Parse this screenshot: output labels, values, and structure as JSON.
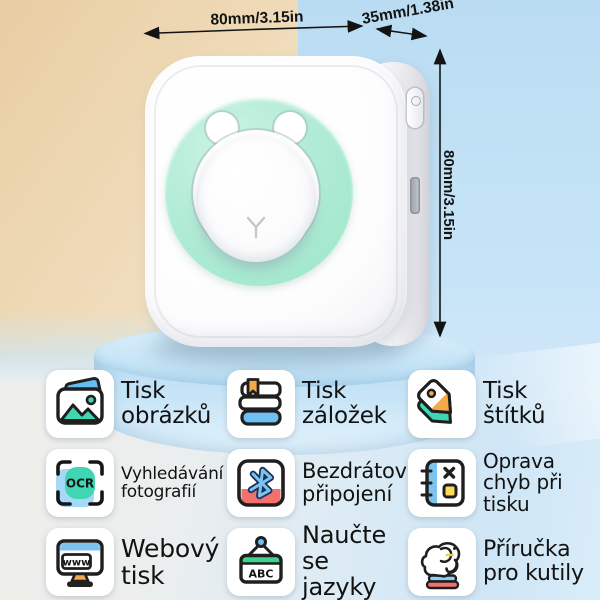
{
  "product": {
    "name": "mini cat thermal printer",
    "dimensions": {
      "width_label": "80mm/3.15in",
      "depth_label": "35mm/1.38in",
      "height_label": "80mm/3.15in"
    },
    "colors": {
      "ring_mint": "#a9e9cf",
      "body_white": "#fdfdfe",
      "pedestal_blue": "#c5e3f6",
      "bg_beige": "#ecd3ac",
      "bg_blue": "#c2e1f5",
      "accent_teal": "#3fd6b3",
      "accent_blue": "#7cc3ef",
      "accent_orange": "#f6a94a",
      "accent_red": "#f2716c",
      "accent_yellow": "#ffd95a",
      "accent_green": "#3ed48e"
    }
  },
  "features": [
    {
      "icon": "photo-icon",
      "label": "Tisk\nobrázků"
    },
    {
      "icon": "books-icon",
      "label": "Tisk\nzáložek"
    },
    {
      "icon": "tag-icon",
      "label": "Tisk\nštítků"
    },
    {
      "icon": "ocr-icon",
      "label": "Vyhledávání\nfotografií",
      "icon_text": "OCR"
    },
    {
      "icon": "bluetooth-icon",
      "label": "Bezdrátové\npřipojení"
    },
    {
      "icon": "notebook-icon",
      "label": "Oprava\nchyb při\ntisku"
    },
    {
      "icon": "monitor-icon",
      "label": "Webový\ntisk",
      "icon_text": "www"
    },
    {
      "icon": "abc-sign-icon",
      "label": "Naučte\nse jazyky",
      "icon_text": "ABC"
    },
    {
      "icon": "elephant-icon",
      "label": "Příručka\npro kutily"
    }
  ]
}
